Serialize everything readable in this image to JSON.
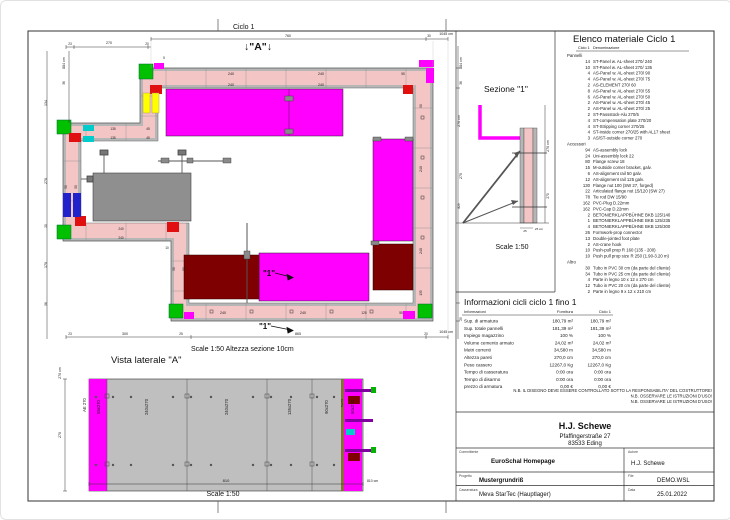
{
  "colors": {
    "panel_magenta": "#ff00ff",
    "wall_pink": "#f4c5c5",
    "formwork_gray": "#b6b6b6",
    "platform_gray": "#8f8f8f",
    "dark_red": "#7e0000",
    "accent_green": "#00c000",
    "accent_red": "#e01010",
    "accent_yellow": "#ffff00",
    "accent_blue": "#2222cc",
    "accent_cyan": "#00cccc",
    "accent_purple": "#8000a0"
  },
  "plan": {
    "title": "Ciclo 1",
    "marker_a": "↓\"A\"↓",
    "marker_1": "\"1\"",
    "scale_note": "Scale 1:50   Altezza sezione 10cm"
  },
  "sezione": {
    "title": "Sezione \"1\"",
    "scale": "Scale 1:50"
  },
  "vista": {
    "title": "Vista laterale \"A\"",
    "scale": "Scale 1:50"
  },
  "drawing": {
    "dim_labels": [
      {
        "x": 287,
        "y": 36,
        "t": "760"
      },
      {
        "x": 428,
        "y": 36,
        "t": "30",
        "s": 3.2
      },
      {
        "x": 452,
        "y": 34,
        "t": "1045 cm",
        "a": "end"
      },
      {
        "x": 69,
        "y": 44,
        "t": "23",
        "s": 3.2
      },
      {
        "x": 108,
        "y": 43,
        "t": "270"
      },
      {
        "x": 146,
        "y": 44,
        "t": "20",
        "s": 3.2
      },
      {
        "x": 163,
        "y": 58,
        "t": "5",
        "s": 3.2
      },
      {
        "x": 64,
        "y": 62,
        "t": "884 cm",
        "r": -90
      },
      {
        "x": 64,
        "y": 82,
        "t": "36",
        "r": -90,
        "s": 3.2
      },
      {
        "x": 46,
        "y": 102,
        "t": "134",
        "r": -90
      },
      {
        "x": 46,
        "y": 180,
        "t": "270",
        "r": -90
      },
      {
        "x": 46,
        "y": 225,
        "t": "20",
        "r": -90,
        "s": 3.2
      },
      {
        "x": 46,
        "y": 264,
        "t": "170",
        "r": -90
      },
      {
        "x": 46,
        "y": 303,
        "t": "56",
        "r": -90,
        "s": 3.2
      },
      {
        "x": 461,
        "y": 62,
        "t": "884 cm",
        "r": -90
      },
      {
        "x": 461,
        "y": 82,
        "t": "36",
        "r": -90,
        "s": 3.2
      },
      {
        "x": 459,
        "y": 120,
        "t": "270 cm",
        "r": -90
      },
      {
        "x": 461,
        "y": 175,
        "t": "270",
        "r": -90
      },
      {
        "x": 459,
        "y": 205,
        "t": "829",
        "r": -90,
        "s": 3.2
      },
      {
        "x": 461,
        "y": 318,
        "t": "25",
        "r": -90,
        "s": 3.2
      },
      {
        "x": 69,
        "y": 334,
        "t": "23",
        "s": 3.2
      },
      {
        "x": 124,
        "y": 334,
        "t": "300"
      },
      {
        "x": 180,
        "y": 334,
        "t": "25",
        "s": 3.2
      },
      {
        "x": 297,
        "y": 334,
        "t": "865"
      },
      {
        "x": 425,
        "y": 334,
        "t": "20",
        "s": 3.2
      },
      {
        "x": 452,
        "y": 332,
        "t": "1045 cm",
        "a": "end"
      },
      {
        "x": 230,
        "y": 74,
        "t": "240"
      },
      {
        "x": 320,
        "y": 74,
        "t": "240"
      },
      {
        "x": 402,
        "y": 74,
        "t": "55",
        "s": 3.2
      },
      {
        "x": 230,
        "y": 85,
        "t": "240"
      },
      {
        "x": 320,
        "y": 85,
        "t": "240"
      },
      {
        "x": 421,
        "y": 105,
        "t": "90",
        "r": -90,
        "s": 3.2
      },
      {
        "x": 421,
        "y": 168,
        "t": "240",
        "r": -90
      },
      {
        "x": 421,
        "y": 250,
        "t": "240",
        "r": -90
      },
      {
        "x": 421,
        "y": 292,
        "t": "135",
        "r": -90,
        "s": 3.2
      },
      {
        "x": 222,
        "y": 313,
        "t": "240"
      },
      {
        "x": 302,
        "y": 313,
        "t": "240"
      },
      {
        "x": 363,
        "y": 313,
        "t": "125",
        "s": 3.2
      },
      {
        "x": 400,
        "y": 313,
        "t": "55",
        "s": 3.2
      },
      {
        "x": 112,
        "y": 129,
        "t": "135",
        "s": 3.2
      },
      {
        "x": 147,
        "y": 129,
        "t": "45",
        "s": 3.2
      },
      {
        "x": 112,
        "y": 138,
        "t": "135",
        "s": 3.2
      },
      {
        "x": 147,
        "y": 138,
        "t": "45",
        "s": 3.2
      },
      {
        "x": 120,
        "y": 229,
        "t": "240",
        "s": 3.2
      },
      {
        "x": 120,
        "y": 238,
        "t": "240",
        "s": 3.2
      },
      {
        "x": 66,
        "y": 186,
        "t": "50",
        "r": -90,
        "s": 3.2
      },
      {
        "x": 76,
        "y": 186,
        "t": "50",
        "r": -90,
        "s": 3.2
      },
      {
        "x": 174,
        "y": 268,
        "t": "50",
        "r": -90,
        "s": 3.2
      },
      {
        "x": 184,
        "y": 268,
        "t": "50",
        "r": -90,
        "s": 3.2
      },
      {
        "x": 166,
        "y": 248,
        "t": "10",
        "s": 3.2
      },
      {
        "x": 548,
        "y": 145,
        "t": "270 cm",
        "r": -90
      },
      {
        "x": 548,
        "y": 195,
        "t": "270",
        "r": -90,
        "s": 3.2
      },
      {
        "x": 524,
        "y": 231,
        "t": "25",
        "s": 3
      },
      {
        "x": 538,
        "y": 229,
        "t": "25 cm",
        "s": 3
      },
      {
        "x": 85,
        "y": 404,
        "t": "AE 270",
        "r": -90,
        "s": 4.2
      },
      {
        "x": 99,
        "y": 406,
        "t": "55x270",
        "r": -90,
        "s": 4.2
      },
      {
        "x": 147,
        "y": 406,
        "t": "240x270",
        "r": -90,
        "s": 4.2
      },
      {
        "x": 227,
        "y": 406,
        "t": "240x270",
        "r": -90,
        "s": 4.2
      },
      {
        "x": 290,
        "y": 406,
        "t": "135x270",
        "r": -90,
        "s": 4.2
      },
      {
        "x": 327,
        "y": 406,
        "t": "90x270",
        "r": -90,
        "s": 4.2
      },
      {
        "x": 342,
        "y": 402,
        "t": "5x270",
        "r": -90,
        "s": 3
      },
      {
        "x": 353,
        "y": 406,
        "t": "50x270",
        "r": -90,
        "s": 4.2
      },
      {
        "x": 60,
        "y": 372,
        "t": "270 cm",
        "r": -90
      },
      {
        "x": 60,
        "y": 434,
        "t": "270",
        "r": -90
      },
      {
        "x": 225,
        "y": 481,
        "t": "810",
        "s": 4
      },
      {
        "x": 366,
        "y": 481,
        "t": "810 cm",
        "s": 3.4,
        "a": "start"
      }
    ]
  },
  "material_list": {
    "title": "Elenco materiale  Ciclo 1",
    "col_header_left": "Ciclo 1",
    "col_header_right": "Denominazione",
    "sections": [
      {
        "name": "Pannelli",
        "items": [
          {
            "q": 14,
            "d": "ST-Panel w. AL-sheet 270/ 240"
          },
          {
            "q": 10,
            "d": "ST-Panel w. AL-sheet 270/ 135"
          },
          {
            "q": 4,
            "d": "AS-Panel w. AL-sheet 270/ 90"
          },
          {
            "q": 4,
            "d": "AS-Panel w. AL-sheet 270/ 75"
          },
          {
            "q": 2,
            "d": "AS-ELEMENT 270/ 60"
          },
          {
            "q": 8,
            "d": "AS-Panel w. AL-sheet 270/ 55"
          },
          {
            "q": 6,
            "d": "AS-Panel w. AL-sheet 270/ 50"
          },
          {
            "q": 2,
            "d": "AS-Panel w. AL-sheet 270/ 45"
          },
          {
            "q": 2,
            "d": "AS-Panel w. AL-sheet 270/ 25"
          },
          {
            "q": 2,
            "d": "ST-Passstück-Alu 270/5"
          },
          {
            "q": 4,
            "d": "ST-compensation plate 270/20"
          },
          {
            "q": 4,
            "d": "ST-Stripping corner 270/25"
          },
          {
            "q": 4,
            "d": "ST-inside corner 270/25 with AL17 sheet"
          },
          {
            "q": 3,
            "d": "AS/ST-outside corner 270"
          }
        ]
      },
      {
        "name": "Accessori",
        "items": [
          {
            "q": 94,
            "d": "AS-assembly lock"
          },
          {
            "q": 24,
            "d": "Uni-assembly lock 22"
          },
          {
            "q": 80,
            "d": "Flange screw 18"
          },
          {
            "q": 15,
            "d": "M-outside corner bracket, galv."
          },
          {
            "q": 6,
            "d": "AS-alignment rail 50  galv."
          },
          {
            "q": 12,
            "d": "AS-alignment rail 125  galv."
          },
          {
            "q": 130,
            "d": "Flange nut 100 (SW 27, forged)"
          },
          {
            "q": 22,
            "d": "Articulated flange nut 15/120 (SW 27)"
          },
          {
            "q": 78,
            "d": "Tie rod DW 15/90"
          },
          {
            "q": 162,
            "d": "PVC-Plug D.22mm"
          },
          {
            "q": 162,
            "d": "PVC-Cap D.22mm"
          },
          {
            "q": 2,
            "d": "BETONIERKLAPPBÜHNE BKB 125/140"
          },
          {
            "q": 1,
            "d": "BETONIERKLAPPBÜHNE BKB 125/235"
          },
          {
            "q": 4,
            "d": "BETONIERKLAPPBÜHNE BKB 125/300"
          },
          {
            "q": 26,
            "d": "Formwork-prop connector"
          },
          {
            "q": 13,
            "d": "Double-jointed foot plate"
          },
          {
            "q": 2,
            "d": "AS-crane hook"
          },
          {
            "q": 10,
            "d": "Push-pull prop R 160 (135 - 200)"
          },
          {
            "q": 10,
            "d": "Push pull prop size R 250 (1.90-3.20 m)"
          }
        ]
      },
      {
        "name": "Altro",
        "items": [
          {
            "q": 30,
            "d": "Tubo in PVC 30 cm (da parte del cliente)"
          },
          {
            "q": 34,
            "d": "Tubo in PVC 25 cm (da parte del cliente)"
          },
          {
            "q": 4,
            "d": "Parte in legno 10 x 12 x 270 cm"
          },
          {
            "q": 12,
            "d": "Tubo in PVC 20 cm (da parte del cliente)"
          },
          {
            "q": 2,
            "d": "Parte in legno 9 x 12 x 210 cm"
          }
        ]
      }
    ]
  },
  "info_table": {
    "title": "Informazioni cicli  ciclo 1 fino 1",
    "columns": [
      "Informazioni",
      "Fornitura",
      "Ciclo 1"
    ],
    "rows": [
      [
        "Sup. di armatura",
        "180,79 m²",
        "180,79 m²"
      ],
      [
        "Sup. totale pannelli",
        "181,39 m²",
        "181,39 m²"
      ],
      [
        "Impiego magazzino",
        "100 %",
        "100 %"
      ],
      [
        "Volume cemento armato",
        "24,02 m³",
        "24,02 m³"
      ],
      [
        "Metri correnti",
        "34,580 m",
        "34,580 m"
      ],
      [
        "Altezza pareti",
        "270,0 cm",
        "270,0 cm"
      ],
      [
        "Peso cassero",
        "12267,0 Kg",
        "12267,0 Kg"
      ],
      [
        "Tempo di casseratura",
        "0:00 ora",
        "0:00 ora"
      ],
      [
        "Tempo di disarmo",
        "0:00 ora",
        "0:00 ora"
      ],
      [
        "prezzo di armatura",
        "0,00 €",
        "0,00 €"
      ]
    ]
  },
  "notes": [
    "N.B. IL DISEGNO DEVE ESSERE CONTROLLATO SOTTO LA RESPONSABILITA' DEL COSTRUTTORE!",
    "N.B. OSSERVARE LE ISTRUZIONI D'USO!",
    "N.B. OSSERVARE LE ISTRUZIONI D'USO!"
  ],
  "title_block": {
    "company": "H.J. Schewe",
    "address_line1": "Pfaffingerstraße 27",
    "address_line2": "83533 Eding",
    "committente_label": "Committente",
    "committente": "EuroSchal Homepage",
    "autore_label": "Autore",
    "autore": "H.J. Schewe",
    "progetto_label": "Progetto",
    "progetto": "Mustergrundriß",
    "file_label": "File",
    "file": "DEMO.WSL",
    "casseratura_label": "Casseratura",
    "casseratura": "Meva StarTec (Hauptlager)",
    "data_label": "Data",
    "data": "25.01.2022"
  }
}
